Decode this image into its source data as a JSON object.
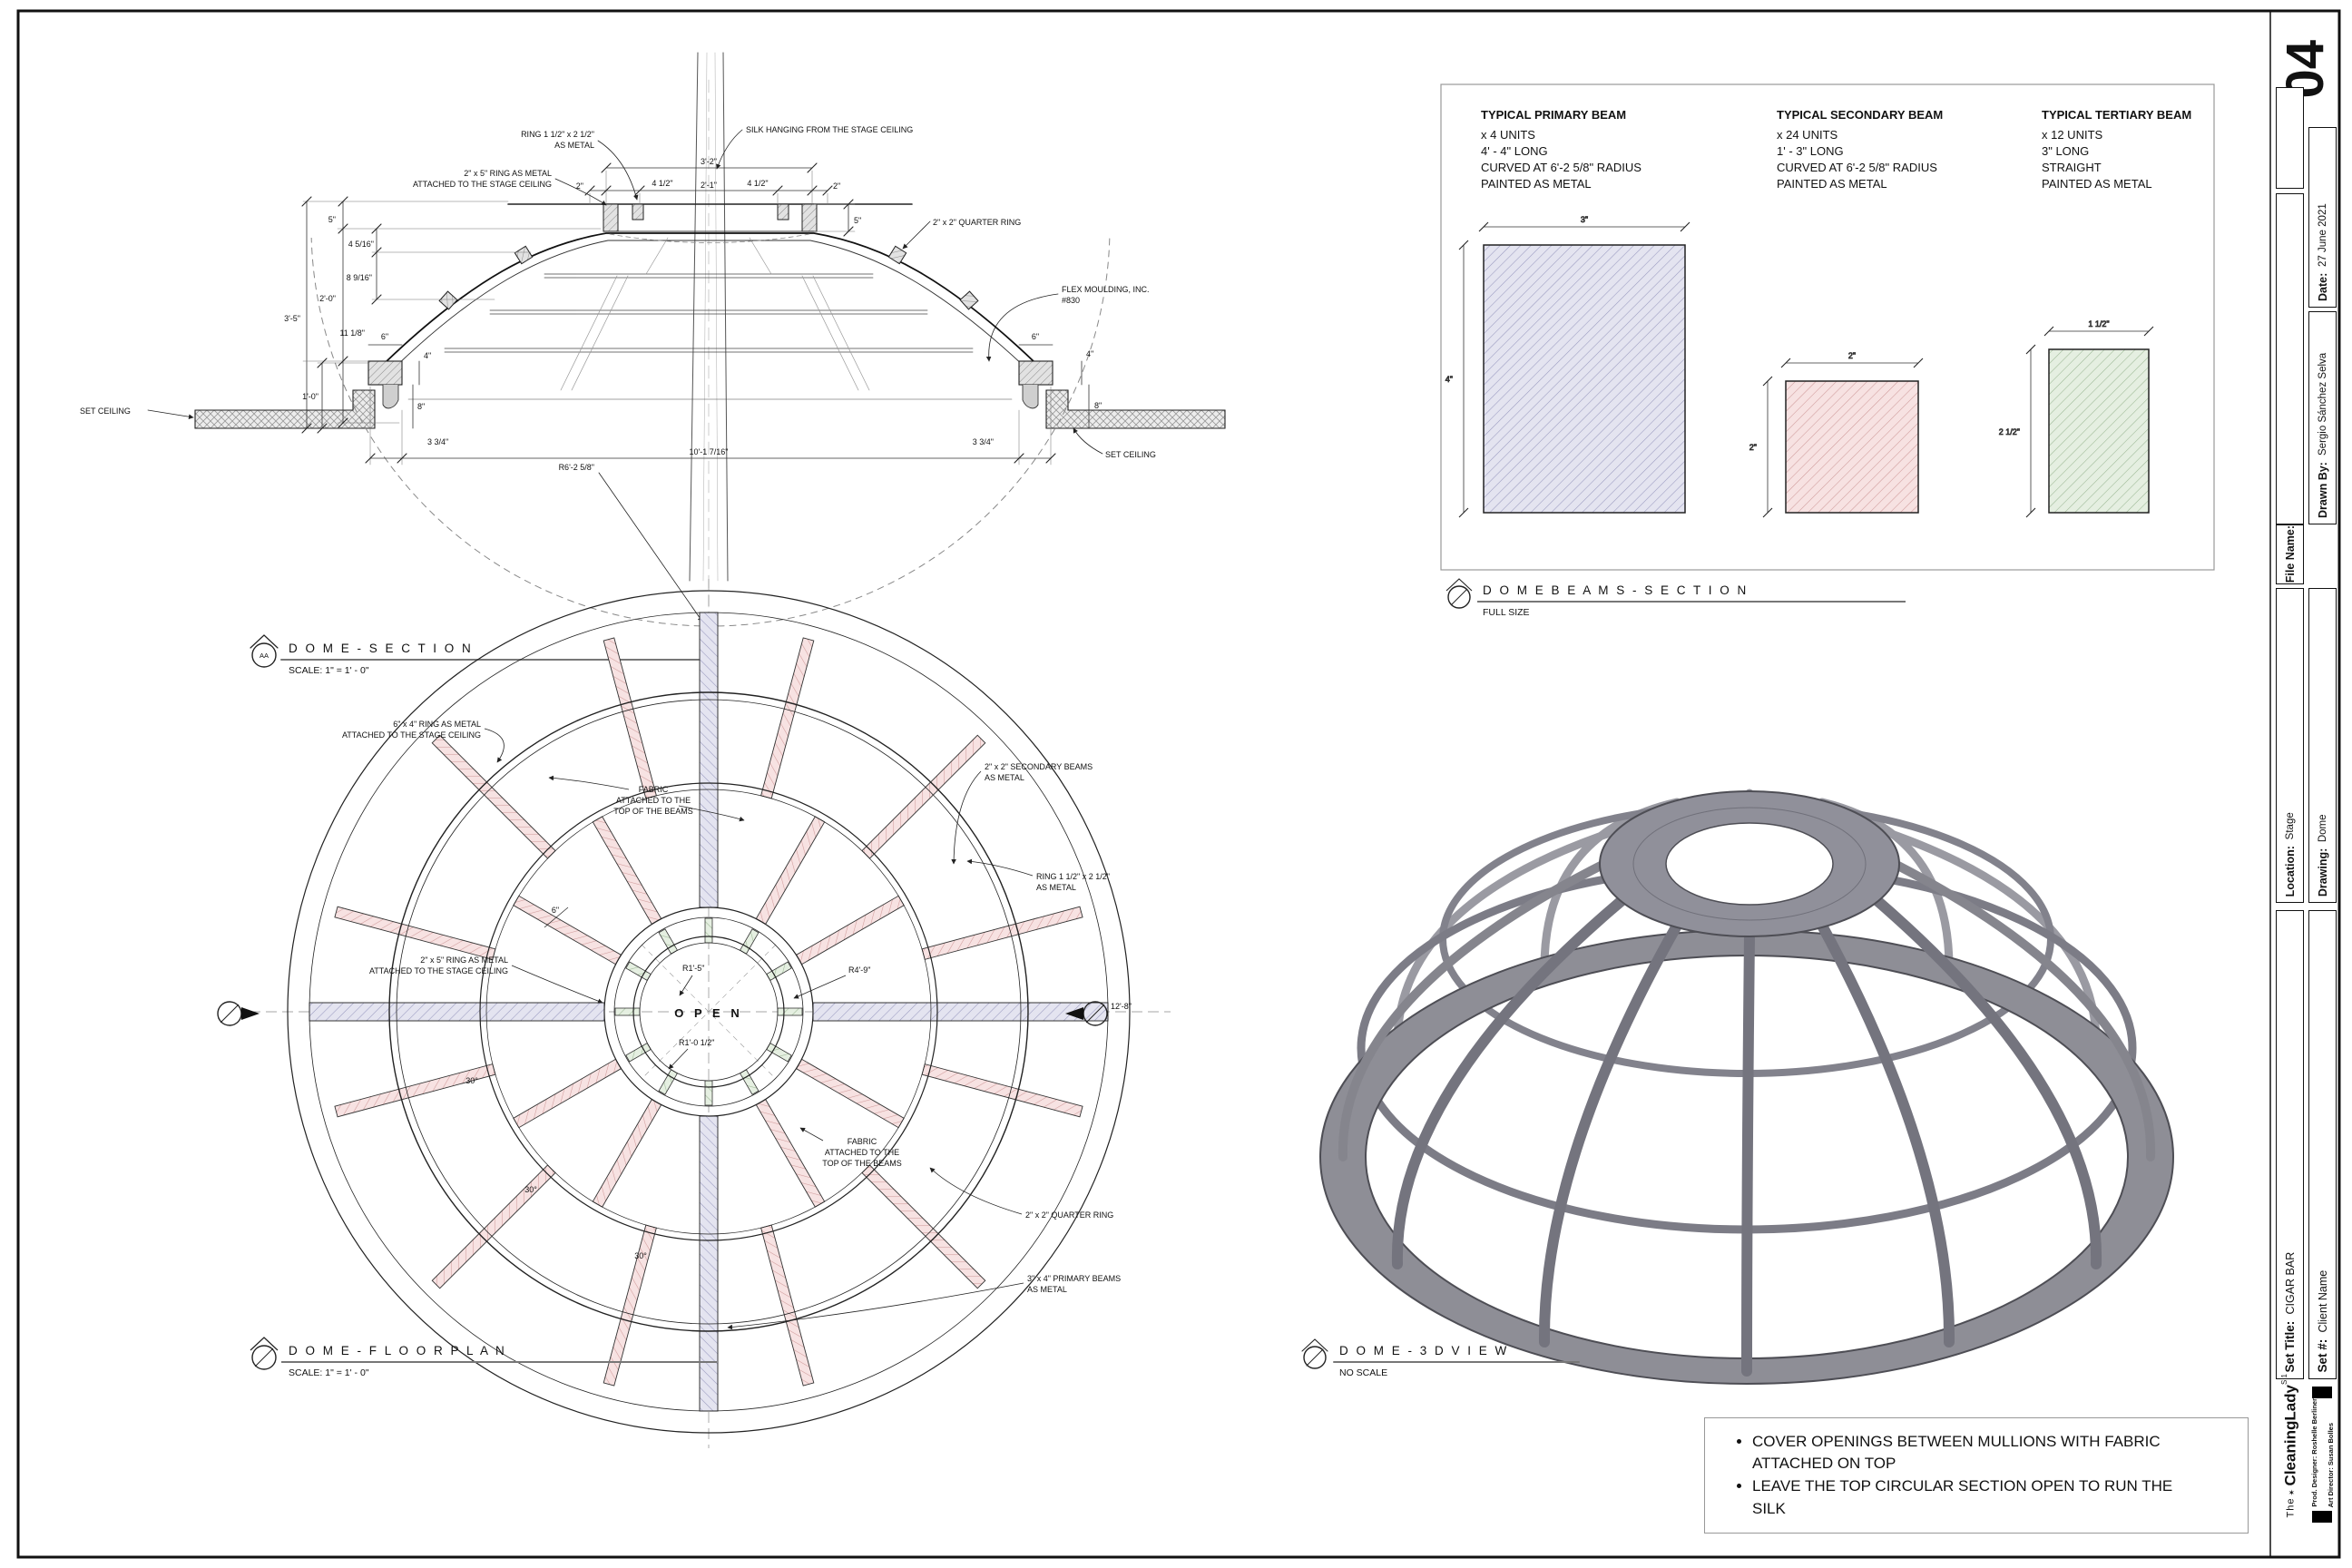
{
  "titleblock": {
    "sheet_number": "04",
    "date_label": "Date:",
    "date_value": "27 June 2021",
    "drawn_label": "Drawn By:",
    "drawn_value": "Sergio Sánchez Selva",
    "file_label": "File Name:",
    "location_label": "Location:",
    "location_value": "Stage",
    "drawing_label": "Drawing:",
    "drawing_value": "Dome",
    "set_title_label": "Set Title:",
    "set_title_value": "CIGAR BAR",
    "set_num_label": "Set #:",
    "set_num_value": "Client Name",
    "logo_the": "The",
    "logo_star": "✶",
    "logo_main": "CleaningLady",
    "logo_sup": "S.1",
    "credit_1": "Prod. Designer: Roshelle Berliner",
    "credit_2": "Art Director: Susan Bolles"
  },
  "section": {
    "title": "D O M E   -   S E C T I O N",
    "scale": "SCALE:  1\" = 1' - 0\"",
    "marker": "AA",
    "labels": {
      "silk": "SILK HANGING FROM THE STAGE CEILING",
      "ring_small_1": "RING 1 1/2\" x 2 1/2\"",
      "ring_small_2": "AS METAL",
      "ring_big_1": "2\" x 5\" RING AS METAL",
      "ring_big_2": "ATTACHED TO THE STAGE CEILING",
      "quarter_ring": "2\" x 2\" QUARTER RING",
      "flex_1": "FLEX MOULDING, INC.",
      "flex_2": "#830",
      "set_ceiling": "SET CEILING"
    },
    "dims": {
      "h_top": "5\"",
      "h_a": "4 5/16\"",
      "h_b": "8 9/16\"",
      "h_c": "2'-0\"",
      "h_overall": "3'-5\"",
      "h_d": "11 1/8\"",
      "h_e": "1'-0\"",
      "w_top": "3'-2\"",
      "w_mid": "2'-1\"",
      "w_side": "4 1/2\"",
      "w_edge": "2\"",
      "ring_h": "5\"",
      "block_w": "6\"",
      "block_h": "4\"",
      "block_d": "8\"",
      "edge": "3 3/4\"",
      "span": "10'-1 7/16\"",
      "radius": "R6'-2 5/8\""
    }
  },
  "floor_plan": {
    "title": "D O M E   -   F L O O R   P L A N",
    "scale": "SCALE:  1\" = 1' - 0\"",
    "open": "O P E N",
    "labels": {
      "ring64_1": "6\" x 4\" RING AS METAL",
      "ring64_2": "ATTACHED TO THE STAGE CEILING",
      "fabric_1": "FABRIC",
      "fabric_2": "ATTACHED TO THE",
      "fabric_3": "TOP OF THE BEAMS",
      "secondary_1": "2\" x 2\" SECONDARY BEAMS",
      "secondary_2": "AS METAL",
      "ring_small_1": "RING 1 1/2\" x 2 1/2\"",
      "ring_small_2": "AS METAL",
      "ring_big_1": "2\" x 5\" RING AS METAL",
      "ring_big_2": "ATTACHED TO THE STAGE CEILING",
      "quarter_ring": "2\" x 2\" QUARTER RING",
      "primary_1": "3\" x 4\" PRIMARY BEAMS",
      "primary_2": "AS METAL"
    },
    "dims": {
      "r_inner": "R1'-5\"",
      "r_mid": "R4'-9\"",
      "r_open": "R1'-0 1/2\"",
      "angle": "30°",
      "diameter": "12'-8\"",
      "ring_w": "6\""
    }
  },
  "beams": {
    "title": "D O M E   B E A M S   -   S E C T I O N",
    "scale": "FULL SIZE",
    "columns": [
      {
        "title": "TYPICAL PRIMARY BEAM",
        "lines": [
          "x 4 UNITS",
          "4' - 4\" LONG",
          "CURVED AT 6'-2 5/8\" RADIUS",
          "PAINTED AS METAL"
        ],
        "dim_w": "3\"",
        "dim_h": "4\""
      },
      {
        "title": "TYPICAL SECONDARY BEAM",
        "lines": [
          "x 24 UNITS",
          "1' - 3\" LONG",
          "CURVED AT 6'-2 5/8\" RADIUS",
          "PAINTED AS METAL"
        ],
        "dim_w": "2\"",
        "dim_h": "2\""
      },
      {
        "title": "TYPICAL TERTIARY BEAM",
        "lines": [
          "x 12 UNITS",
          "3\" LONG",
          "STRAIGHT",
          "PAINTED AS METAL"
        ],
        "dim_w": "1 1/2\"",
        "dim_h": "2 1/2\""
      }
    ]
  },
  "view3d": {
    "title": "D O M E   -   3 D   V I E W",
    "scale": "NO SCALE"
  },
  "notes": {
    "items": [
      "COVER OPENINGS BETWEEN MULLIONS  WITH FABRIC ATTACHED ON TOP",
      "LEAVE THE TOP CIRCULAR SECTION OPEN TO RUN THE SILK"
    ]
  },
  "colors": {
    "primary_beam": "#9a9ac0",
    "secondary_beam": "#d09a9a",
    "tertiary_beam": "#9cb894",
    "metal_3d": "#8e8e96",
    "line": "#111111"
  }
}
